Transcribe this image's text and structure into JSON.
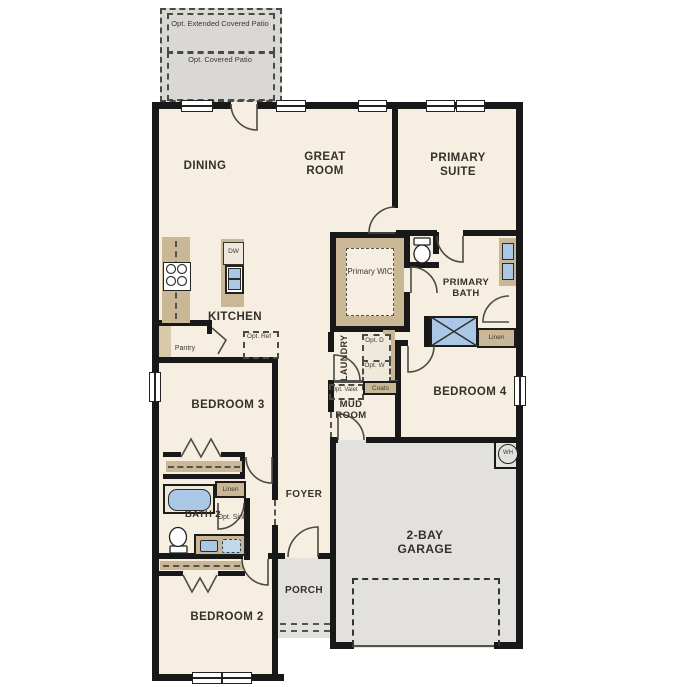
{
  "floor_plan": {
    "patio": {
      "extended": "Opt. Extended Covered Patio",
      "covered": "Opt. Covered Patio"
    },
    "rooms": {
      "dining": "DINING",
      "great_room": "GREAT ROOM",
      "primary_suite": "PRIMARY SUITE",
      "kitchen": "KITCHEN",
      "primary_wic": "Primary WIC",
      "primary_bath": "PRIMARY BATH",
      "laundry": "LAUNDRY",
      "mud_room": "MUD ROOM",
      "bedroom_4": "BEDROOM 4",
      "bedroom_3": "BEDROOM 3",
      "bath_2": "BATH 2",
      "foyer": "FOYER",
      "porch": "PORCH",
      "bedroom_2": "BEDROOM 2",
      "garage": "2-BAY GARAGE"
    },
    "closets": {
      "pantry": "Pantry",
      "coats": "Coats",
      "linen_bath": "Linen",
      "linen_hall": "Linen"
    },
    "options": {
      "ref": "Opt. Ref",
      "dryer": "Opt. D",
      "washer": "Opt. W",
      "valet": "Opt. Valet",
      "sink": "Opt. Sink"
    },
    "appliances": {
      "dishwasher": "DW",
      "water_heater": "WH"
    },
    "colors": {
      "floor": "#f6efe1",
      "patio_gray": "#dad8d4",
      "garage_gray": "#e2e1de",
      "cabinet_tan": "#c9b795",
      "fixture_blue": "#aac8e6",
      "wall": "#181818"
    }
  }
}
